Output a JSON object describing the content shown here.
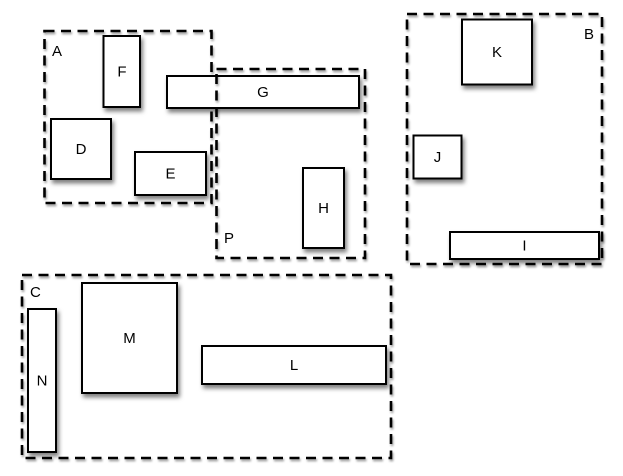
{
  "diagram": {
    "colors": {
      "background": "#ffffff",
      "stroke": "#000000",
      "box_fill": "#ffffff",
      "shadow": "#888888"
    },
    "containers": [
      {
        "label": "A"
      },
      {
        "label": "B"
      },
      {
        "label": "C"
      },
      {
        "label": "P"
      }
    ],
    "boxes": [
      {
        "label": "D"
      },
      {
        "label": "E"
      },
      {
        "label": "F"
      },
      {
        "label": "G"
      },
      {
        "label": "H"
      },
      {
        "label": "I"
      },
      {
        "label": "J"
      },
      {
        "label": "K"
      },
      {
        "label": "L"
      },
      {
        "label": "M"
      },
      {
        "label": "N"
      }
    ]
  }
}
